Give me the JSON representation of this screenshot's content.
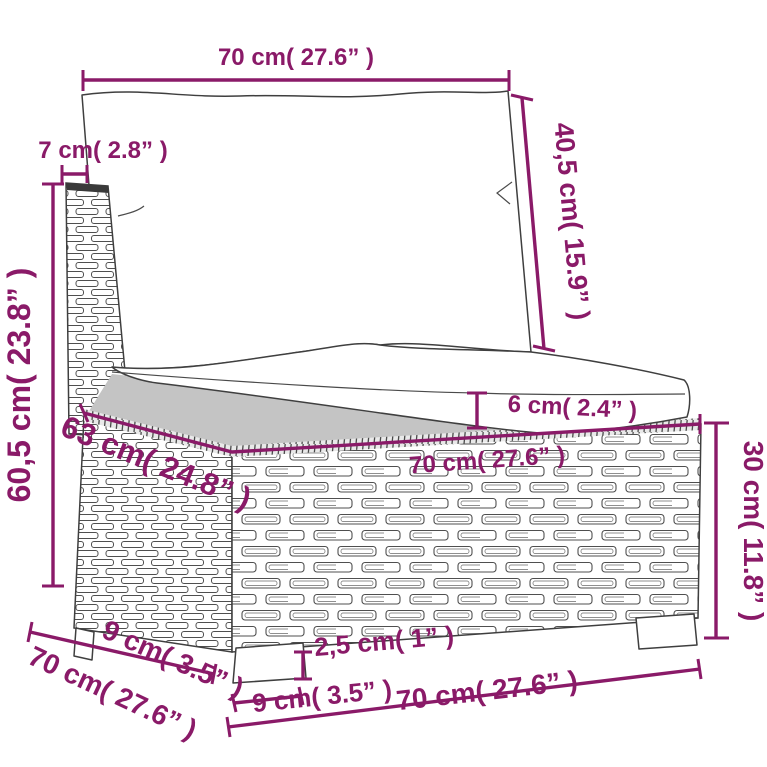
{
  "colors": {
    "annotation": "#8a1a68",
    "outline": "#3f3f3f",
    "background": "#ffffff"
  },
  "diagram": {
    "subject": "poly-rattan sofa middle section with cushions",
    "annotations": {
      "top_width": "70 cm( 27.6” )",
      "back_thickness": "7 cm( 2.8” )",
      "back_cushion_height": "40,5 cm( 15.9” )",
      "overall_height": "60,5 cm( 23.8” )",
      "cushion_thickness": "6 cm( 2.4” )",
      "seat_depth": "63 cm( 24.8” )",
      "seat_width": "70 cm( 27.6” )",
      "base_height": "30 cm( 11.8” )",
      "leg_height": "2,5 cm( 1” )",
      "leg_width": "9 cm( 3.5” )",
      "side_leg_depth": "9 cm( 3.5” )",
      "side_depth": "70 cm( 27.6” )",
      "bottom_width": "70 cm( 27.6” )"
    }
  }
}
